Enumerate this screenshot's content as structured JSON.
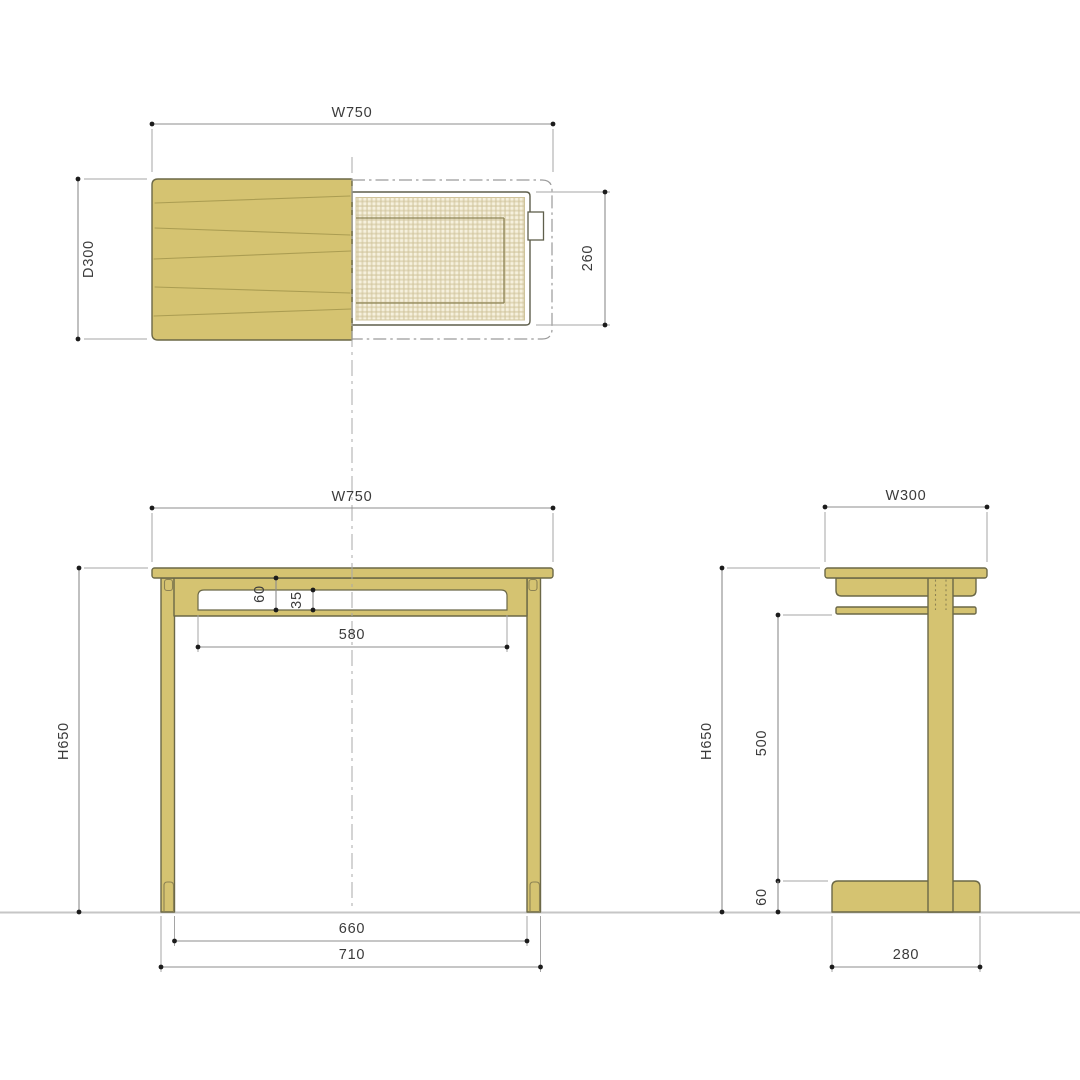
{
  "drawing": {
    "type": "furniture-dimension-drawing",
    "colors": {
      "wood": "#d5c371",
      "wood_outline": "#6b6847",
      "grain": "#ab9d52",
      "detail_line": "#8c8253",
      "mesh_bg": "#f6f1de",
      "mesh_line": "#cfc39a",
      "drawer_outline": "#5f5f4c",
      "opening": "#ffffff",
      "dim_line": "#8c8c8c",
      "ext_line": "#a5a5a5",
      "dim_dot": "#1c1c1c",
      "dim_text": "#3b3b3b",
      "ground": "#c6c6c6",
      "centerline": "#a9a9a9",
      "hidden_line": "#9a9a9a"
    },
    "views": {
      "plan": {
        "dims": {
          "width": "W750",
          "depth": "D300",
          "drawer_depth": "260"
        }
      },
      "front": {
        "dims": {
          "width": "W750",
          "height": "H650",
          "apron_height": "60",
          "opening_height": "35",
          "opening_width": "580",
          "inner_leg_span": "660",
          "outer_leg_span": "710"
        }
      },
      "side": {
        "dims": {
          "width": "W300",
          "height": "H650",
          "under_clearance": "500",
          "foot_height": "60",
          "foot_depth": "280"
        }
      }
    }
  }
}
